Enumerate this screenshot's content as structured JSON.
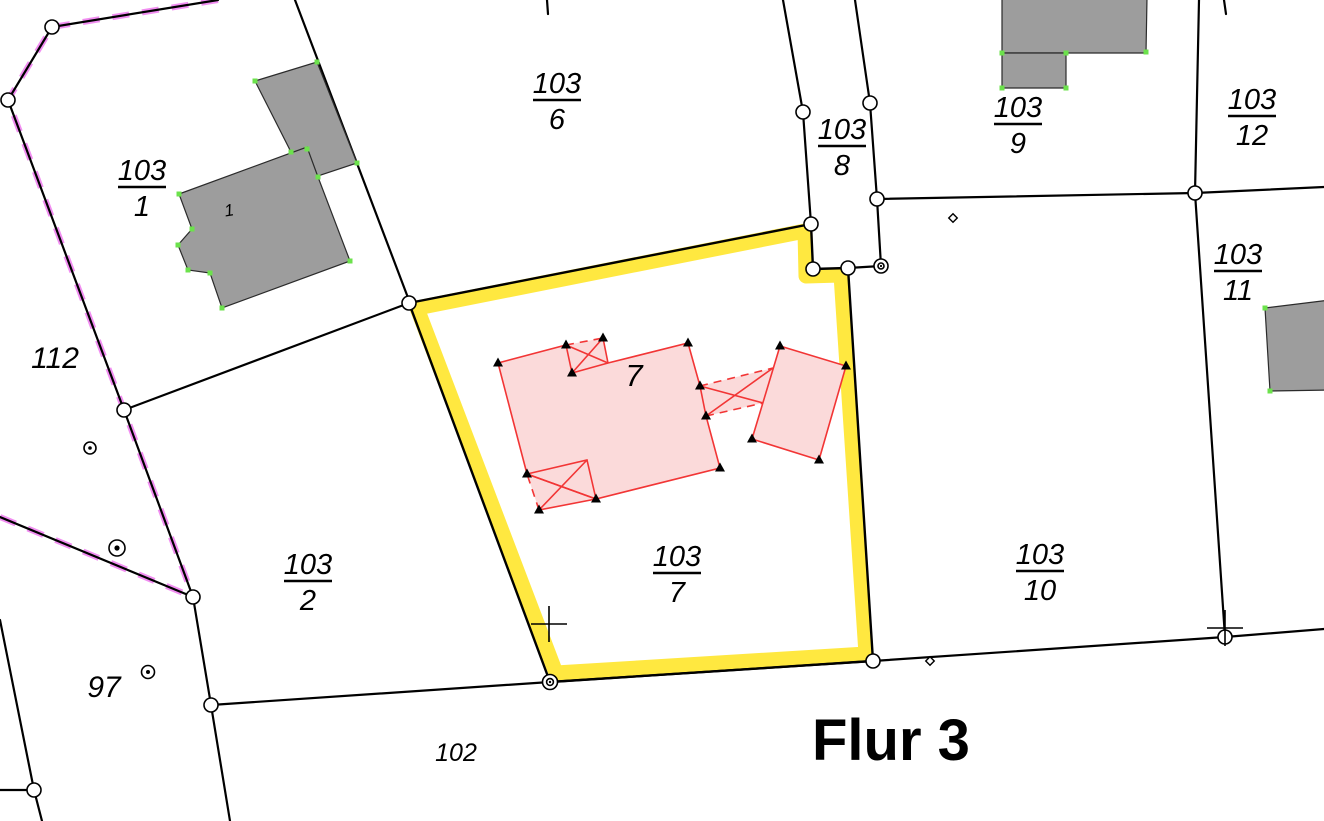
{
  "map": {
    "flur_label": "Flur 3",
    "selected_parcel": "103/7",
    "parcel_labels": [
      {
        "id": "103-1",
        "num": "103",
        "den": "1"
      },
      {
        "id": "103-6",
        "num": "103",
        "den": "6"
      },
      {
        "id": "103-8",
        "num": "103",
        "den": "8"
      },
      {
        "id": "103-9",
        "num": "103",
        "den": "9"
      },
      {
        "id": "103-12",
        "num": "103",
        "den": "12"
      },
      {
        "id": "103-11",
        "num": "103",
        "den": "11"
      },
      {
        "id": "103-2",
        "num": "103",
        "den": "2"
      },
      {
        "id": "103-7",
        "num": "103",
        "den": "7"
      },
      {
        "id": "103-10",
        "num": "103",
        "den": "10"
      }
    ],
    "neighbor_parcel_labels": [
      {
        "id": "112",
        "text": "112"
      },
      {
        "id": "97",
        "text": "97"
      },
      {
        "id": "102",
        "text": "102"
      }
    ],
    "house_number_labels": [
      {
        "id": "house-1",
        "text": "1"
      },
      {
        "id": "house-7",
        "text": "7"
      }
    ],
    "colors": {
      "selection_yellow": "#ffe840",
      "boundary_black": "#000000",
      "building_gray": "#9d9d9d",
      "building_pink_fill": "#fbdada",
      "building_pink_stroke": "#f23535",
      "corner_marker_green": "#6ce24c",
      "edited_boundary_purple": "#ef82ef"
    },
    "symbols": {
      "boundary_vertex": "white-circle-marker",
      "control_point": "circled-dot-marker",
      "survey_cross": "cross-marker",
      "minor_point": "diamond-marker",
      "building_corner_surveyed": "triangle-marker",
      "building_corner_checked": "green-dot-marker"
    }
  }
}
